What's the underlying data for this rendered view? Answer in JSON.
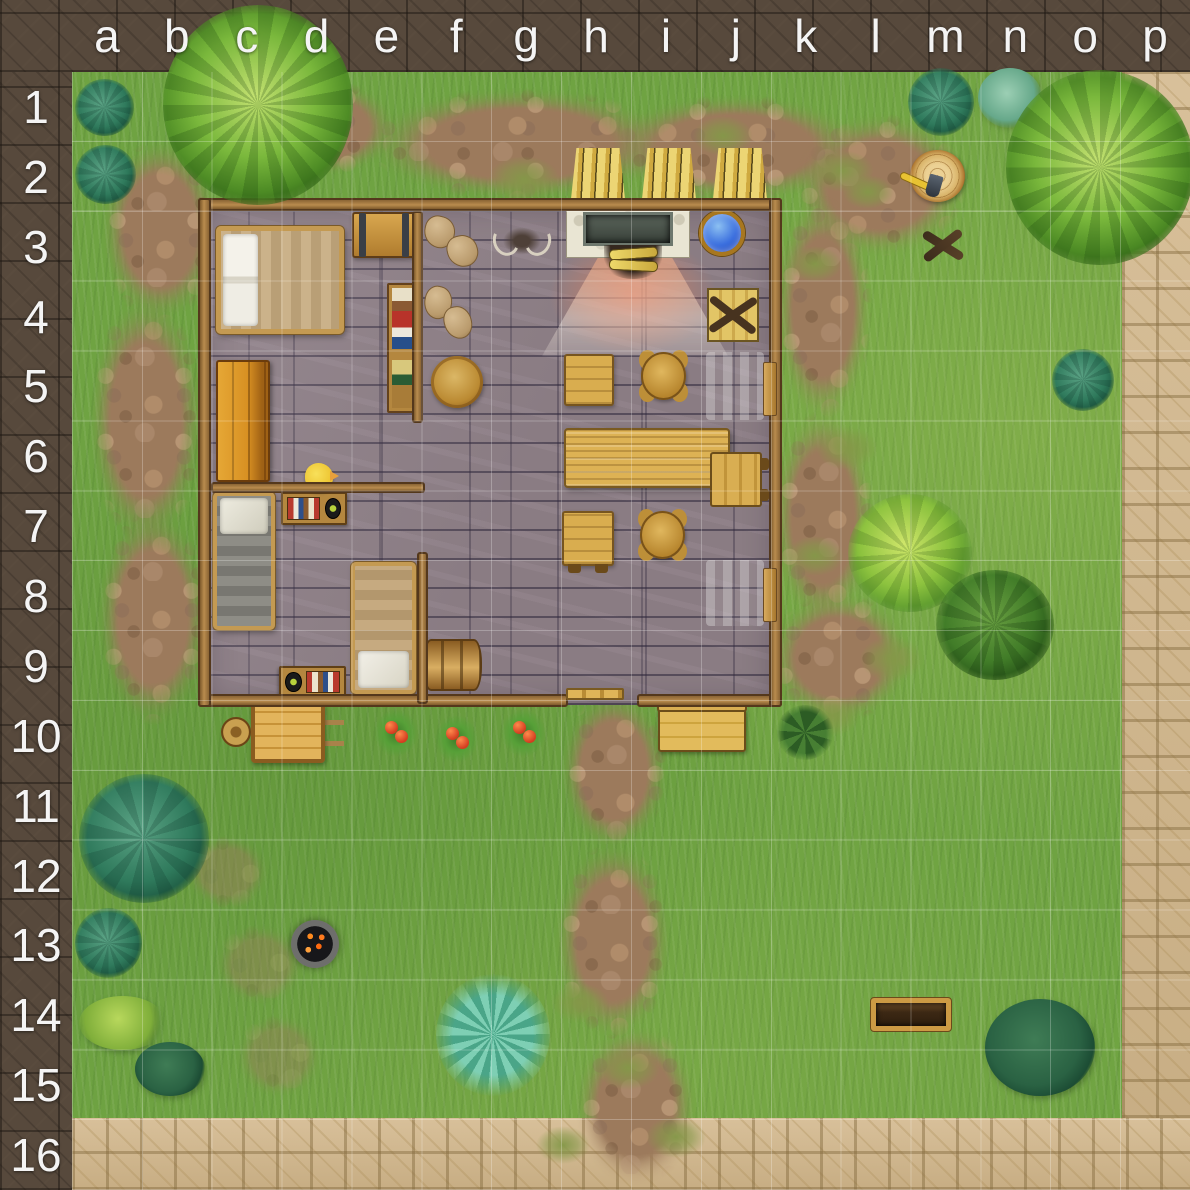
{
  "map": {
    "columns": [
      "a",
      "b",
      "c",
      "d",
      "e",
      "f",
      "g",
      "h",
      "i",
      "j",
      "k",
      "l",
      "m",
      "n",
      "o",
      "p"
    ],
    "rows": [
      "1",
      "2",
      "3",
      "4",
      "5",
      "6",
      "7",
      "8",
      "9",
      "10",
      "11",
      "12",
      "13",
      "14",
      "15",
      "16"
    ],
    "palette": {
      "border_frame": "#57493c",
      "grass": "#6fa342",
      "dirt_path": "#9c7a5c",
      "stone_path": "#cfb68d",
      "house_floor": "#8a7c83",
      "house_wall": "#a5793e",
      "water": "#3a6ede",
      "fire_glow": "#ff7346",
      "label_text": "#f4f4f4"
    },
    "features": [
      {
        "name": "stone-path-right",
        "type": "stonepath",
        "x": 1122,
        "y": 72,
        "w": 68,
        "h": 1118
      },
      {
        "name": "stone-path-bottom",
        "type": "stonepath",
        "x": 72,
        "y": 1118,
        "w": 1118,
        "h": 72
      },
      {
        "name": "dirt-path-top-a",
        "type": "dirt",
        "x": 250,
        "y": 78,
        "w": 150,
        "h": 100
      },
      {
        "name": "dirt-path-top-b",
        "type": "dirt",
        "x": 360,
        "y": 85,
        "w": 320,
        "h": 118
      },
      {
        "name": "dirt-path-top-c",
        "type": "dirt",
        "x": 600,
        "y": 92,
        "w": 270,
        "h": 112
      },
      {
        "name": "dirt-path-top-right",
        "type": "dirt",
        "x": 790,
        "y": 110,
        "w": 180,
        "h": 150
      },
      {
        "name": "dirt-path-left-a",
        "type": "dirt",
        "x": 98,
        "y": 135,
        "w": 125,
        "h": 190
      },
      {
        "name": "dirt-path-left-b",
        "type": "dirt",
        "x": 86,
        "y": 290,
        "w": 120,
        "h": 260
      },
      {
        "name": "dirt-path-left-c",
        "type": "dirt",
        "x": 94,
        "y": 505,
        "w": 118,
        "h": 225
      },
      {
        "name": "dirt-path-east-a",
        "type": "dirt",
        "x": 772,
        "y": 190,
        "w": 102,
        "h": 235
      },
      {
        "name": "dirt-path-east-b",
        "type": "dirt",
        "x": 770,
        "y": 405,
        "w": 106,
        "h": 225
      },
      {
        "name": "dirt-path-east-c",
        "type": "dirt",
        "x": 765,
        "y": 590,
        "w": 148,
        "h": 135
      },
      {
        "name": "dirt-path-door-a",
        "type": "dirt",
        "x": 558,
        "y": 688,
        "w": 112,
        "h": 165
      },
      {
        "name": "dirt-path-door-b",
        "type": "dirt",
        "x": 552,
        "y": 838,
        "w": 122,
        "h": 205
      },
      {
        "name": "dirt-path-door-c",
        "type": "dirt",
        "x": 572,
        "y": 1022,
        "w": 128,
        "h": 168
      },
      {
        "name": "dirt-patch-faint-a",
        "type": "dirt",
        "x": 183,
        "y": 833,
        "w": 88,
        "h": 78,
        "opacity": 0.45
      },
      {
        "name": "dirt-patch-faint-b",
        "type": "dirt",
        "x": 212,
        "y": 922,
        "w": 95,
        "h": 85,
        "opacity": 0.4
      },
      {
        "name": "dirt-patch-faint-c",
        "type": "dirt",
        "x": 233,
        "y": 1012,
        "w": 92,
        "h": 88,
        "opacity": 0.4
      },
      {
        "name": "grass-tuft-1",
        "type": "tuft",
        "x": 488,
        "y": 156,
        "w": 72,
        "h": 46
      },
      {
        "name": "grass-tuft-2",
        "type": "tuft",
        "x": 693,
        "y": 116,
        "w": 60,
        "h": 40
      },
      {
        "name": "grass-tuft-3",
        "type": "tuft",
        "x": 810,
        "y": 150,
        "w": 64,
        "h": 42
      },
      {
        "name": "grass-tuft-4",
        "type": "tuft",
        "x": 788,
        "y": 246,
        "w": 54,
        "h": 36
      },
      {
        "name": "grass-tuft-5",
        "type": "tuft",
        "x": 842,
        "y": 175,
        "w": 52,
        "h": 34
      },
      {
        "name": "grass-tuft-6",
        "type": "tuft",
        "x": 693,
        "y": 383,
        "w": 58,
        "h": 40
      },
      {
        "name": "grass-tuft-7",
        "type": "tuft",
        "x": 816,
        "y": 426,
        "w": 62,
        "h": 44
      },
      {
        "name": "grass-tuft-8",
        "type": "tuft",
        "x": 786,
        "y": 536,
        "w": 58,
        "h": 40
      },
      {
        "name": "grass-tuft-9",
        "type": "tuft",
        "x": 860,
        "y": 636,
        "w": 64,
        "h": 46
      },
      {
        "name": "grass-tuft-10",
        "type": "tuft",
        "x": 806,
        "y": 696,
        "w": 54,
        "h": 40
      },
      {
        "name": "grass-tuft-11",
        "type": "tuft",
        "x": 551,
        "y": 983,
        "w": 58,
        "h": 40
      },
      {
        "name": "grass-tuft-12",
        "type": "tuft",
        "x": 596,
        "y": 1046,
        "w": 64,
        "h": 44
      },
      {
        "name": "grass-tuft-13",
        "type": "tuft",
        "x": 536,
        "y": 1126,
        "w": 54,
        "h": 38
      },
      {
        "name": "grass-tuft-14",
        "type": "tuft",
        "x": 646,
        "y": 1116,
        "w": 60,
        "h": 42
      },
      {
        "name": "house-floor",
        "type": "floor",
        "x": 205,
        "y": 205,
        "w": 570,
        "h": 500
      },
      {
        "name": "window-light-east-1",
        "type": "beam",
        "x": 706,
        "y": 352,
        "w": 58,
        "h": 68
      },
      {
        "name": "window-light-east-2",
        "type": "beam",
        "x": 706,
        "y": 560,
        "w": 58,
        "h": 66
      },
      {
        "name": "fireplace-glow",
        "type": "glow",
        "x": 549,
        "y": 236,
        "w": 168,
        "h": 118
      },
      {
        "name": "fireplace-light-cone",
        "type": "cone",
        "x": 542,
        "y": 248,
        "w": 186,
        "h": 108
      },
      {
        "name": "fireplace",
        "type": "fireplace",
        "x": 566,
        "y": 204,
        "w": 124,
        "h": 54
      },
      {
        "name": "firewood-logs",
        "type": "logs",
        "x": 604,
        "y": 245,
        "w": 58,
        "h": 34
      },
      {
        "name": "water-basin",
        "type": "pool",
        "x": 699,
        "y": 210,
        "w": 46,
        "h": 46
      },
      {
        "name": "broken-crate",
        "type": "crate",
        "x": 707,
        "y": 288,
        "w": 52,
        "h": 54
      },
      {
        "name": "double-bed",
        "type": "bed-double",
        "x": 216,
        "y": 226,
        "w": 128,
        "h": 108
      },
      {
        "name": "storage-chest",
        "type": "chest",
        "x": 352,
        "y": 212,
        "w": 64,
        "h": 46
      },
      {
        "name": "grain-sacks-1",
        "type": "sacks",
        "x": 424,
        "y": 215,
        "w": 54,
        "h": 52
      },
      {
        "name": "grain-sacks-2",
        "type": "sacks",
        "x": 424,
        "y": 285,
        "w": 48,
        "h": 54
      },
      {
        "name": "antler-trophy",
        "type": "trophy",
        "x": 494,
        "y": 221,
        "w": 56,
        "h": 40
      },
      {
        "name": "bookshelf",
        "type": "bookshelf",
        "x": 387,
        "y": 283,
        "w": 33,
        "h": 130
      },
      {
        "name": "round-table",
        "type": "roundtable",
        "x": 431,
        "y": 356,
        "w": 52,
        "h": 52
      },
      {
        "name": "wardrobe",
        "type": "wardrobe",
        "x": 216,
        "y": 360,
        "w": 54,
        "h": 122
      },
      {
        "name": "square-table-north",
        "type": "tablesq",
        "x": 564,
        "y": 354,
        "w": 50,
        "h": 52
      },
      {
        "name": "round-stool-north",
        "type": "stool",
        "x": 641,
        "y": 352,
        "w": 45,
        "h": 48
      },
      {
        "name": "big-dining-table",
        "type": "tablebig",
        "x": 564,
        "y": 428,
        "w": 166,
        "h": 60
      },
      {
        "name": "small-bench-east",
        "type": "benchsm",
        "x": 710,
        "y": 452,
        "w": 52,
        "h": 55
      },
      {
        "name": "square-table-south",
        "type": "tablesq",
        "cls": "feet",
        "x": 562,
        "y": 511,
        "w": 52,
        "h": 55
      },
      {
        "name": "round-stool-south",
        "type": "stool",
        "x": 640,
        "y": 511,
        "w": 45,
        "h": 48
      },
      {
        "name": "single-bed-gray",
        "type": "bed-gray",
        "x": 213,
        "y": 492,
        "w": 62,
        "h": 138
      },
      {
        "name": "book-table-north",
        "type": "shelfbooks",
        "x": 281,
        "y": 492,
        "w": 66,
        "h": 33
      },
      {
        "name": "yellow-bird",
        "type": "bird",
        "x": 305,
        "y": 463,
        "w": 28,
        "h": 27
      },
      {
        "name": "single-bed-tan",
        "type": "bed-tan",
        "x": 351,
        "y": 562,
        "w": 65,
        "h": 132
      },
      {
        "name": "barrel",
        "type": "barrel",
        "x": 423,
        "y": 639,
        "w": 59,
        "h": 52
      },
      {
        "name": "book-table-south",
        "type": "shelfbooks",
        "cls": "flip",
        "x": 279,
        "y": 666,
        "w": 67,
        "h": 32
      },
      {
        "name": "wall-north",
        "type": "wall-h",
        "x": 198,
        "y": 198,
        "w": 584,
        "h": 13,
        "z": 5
      },
      {
        "name": "wall-south-west",
        "type": "wall-h",
        "x": 198,
        "y": 694,
        "w": 370,
        "h": 13,
        "z": 5
      },
      {
        "name": "wall-south-east",
        "type": "wall-h",
        "x": 637,
        "y": 694,
        "w": 145,
        "h": 13,
        "z": 5
      },
      {
        "name": "wall-west",
        "type": "wall-v",
        "x": 198,
        "y": 198,
        "w": 13,
        "h": 509,
        "z": 5
      },
      {
        "name": "wall-east",
        "type": "wall-v",
        "x": 769,
        "y": 198,
        "w": 13,
        "h": 509,
        "z": 5
      },
      {
        "name": "wall-inner-vertical-north",
        "type": "wall-v",
        "x": 412,
        "y": 211,
        "w": 11,
        "h": 212,
        "z": 5
      },
      {
        "name": "wall-inner-horizontal",
        "type": "wall-h",
        "x": 211,
        "y": 482,
        "w": 214,
        "h": 11,
        "z": 5
      },
      {
        "name": "wall-inner-vertical-south",
        "type": "wall-v",
        "x": 417,
        "y": 552,
        "w": 11,
        "h": 152,
        "z": 5
      },
      {
        "name": "door-threshold",
        "type": "step",
        "x": 566,
        "y": 688,
        "w": 58,
        "h": 12,
        "z": 5
      },
      {
        "name": "window-shutter-1",
        "type": "shutter",
        "x": 763,
        "y": 362,
        "w": 14,
        "h": 54,
        "z": 6
      },
      {
        "name": "window-shutter-2",
        "type": "shutter",
        "x": 763,
        "y": 568,
        "w": 14,
        "h": 54,
        "z": 6
      },
      {
        "name": "hay-sheaf-1",
        "type": "hay",
        "x": 571,
        "y": 148,
        "w": 54,
        "h": 51
      },
      {
        "name": "hay-sheaf-2",
        "type": "hay",
        "x": 642,
        "y": 148,
        "w": 54,
        "h": 51
      },
      {
        "name": "hay-sheaf-3",
        "type": "hay",
        "x": 713,
        "y": 148,
        "w": 54,
        "h": 51
      },
      {
        "name": "tree-stump-with-axe",
        "type": "stump",
        "x": 910,
        "y": 150,
        "w": 55,
        "h": 52
      },
      {
        "name": "crossed-sticks",
        "type": "sticks",
        "x": 920,
        "y": 224,
        "w": 46,
        "h": 42
      },
      {
        "name": "wheelbarrow",
        "type": "wheelbarrow",
        "x": 218,
        "y": 702,
        "w": 126,
        "h": 62
      },
      {
        "name": "tomato-plant-1",
        "type": "tomato",
        "x": 374,
        "y": 709,
        "w": 44,
        "h": 48
      },
      {
        "name": "tomato-plant-2",
        "type": "tomato",
        "x": 435,
        "y": 715,
        "w": 43,
        "h": 48
      },
      {
        "name": "tomato-plant-3",
        "type": "tomato",
        "x": 501,
        "y": 709,
        "w": 45,
        "h": 48
      },
      {
        "name": "garden-bench",
        "type": "benchout",
        "x": 658,
        "y": 708,
        "w": 88,
        "h": 44
      },
      {
        "name": "leafy-plant",
        "type": "plantleafy",
        "x": 776,
        "y": 705,
        "w": 58,
        "h": 55
      },
      {
        "name": "wooden-trough",
        "type": "trough",
        "x": 871,
        "y": 998,
        "w": 80,
        "h": 33
      },
      {
        "name": "fire-pit",
        "type": "firepit",
        "x": 291,
        "y": 920,
        "w": 48,
        "h": 48
      },
      {
        "name": "teal-fern-tree",
        "type": "ferntree",
        "cls": "f-veg",
        "x": 436,
        "y": 974,
        "w": 114,
        "h": 122
      },
      {
        "name": "dark-bush-n14",
        "type": "bushdark",
        "cls": "f-veg",
        "x": 985,
        "y": 999,
        "w": 110,
        "h": 97
      },
      {
        "name": "bright-leafy-tree",
        "type": "treebright",
        "cls": "f-veg",
        "x": 848,
        "y": 494,
        "w": 124,
        "h": 118
      },
      {
        "name": "dark-leafy-tree",
        "type": "treedark",
        "cls": "f-veg",
        "x": 936,
        "y": 570,
        "w": 118,
        "h": 110
      },
      {
        "name": "teal-bush-n5",
        "type": "bushteal",
        "cls": "f-veg",
        "x": 1052,
        "y": 349,
        "w": 62,
        "h": 62
      },
      {
        "name": "teal-bush-a1",
        "type": "bushteal",
        "cls": "f-veg",
        "x": 75,
        "y": 79,
        "w": 59,
        "h": 57
      },
      {
        "name": "teal-bush-a2",
        "type": "bushteal",
        "cls": "f-veg",
        "x": 75,
        "y": 145,
        "w": 61,
        "h": 59
      },
      {
        "name": "big-tree-top-left",
        "type": "treeconifer",
        "cls": "f-veg",
        "x": 163,
        "y": 5,
        "w": 190,
        "h": 200
      },
      {
        "name": "teal-bush-m1",
        "type": "bushteal",
        "cls": "f-veg",
        "x": 908,
        "y": 68,
        "w": 66,
        "h": 68
      },
      {
        "name": "fuzzy-teal-bush-n1",
        "type": "bushfuzzy",
        "cls": "f-veg",
        "x": 978,
        "y": 68,
        "w": 64,
        "h": 60
      },
      {
        "name": "big-tree-top-right",
        "type": "treeconifer",
        "cls": "f-veg",
        "x": 1006,
        "y": 70,
        "w": 188,
        "h": 195
      },
      {
        "name": "big-teal-bush-a11",
        "type": "bushteal",
        "cls": "f-veg",
        "x": 79,
        "y": 774,
        "w": 130,
        "h": 129
      },
      {
        "name": "teal-bush-a13",
        "type": "bushteal",
        "cls": "f-veg",
        "x": 75,
        "y": 908,
        "w": 67,
        "h": 70
      },
      {
        "name": "light-bush-a14",
        "type": "bushlight",
        "cls": "f-veg",
        "x": 79,
        "y": 996,
        "w": 87,
        "h": 54
      },
      {
        "name": "dark-bush-b14",
        "type": "bushdark",
        "cls": "f-veg",
        "x": 135,
        "y": 1042,
        "w": 70,
        "h": 54
      }
    ]
  }
}
